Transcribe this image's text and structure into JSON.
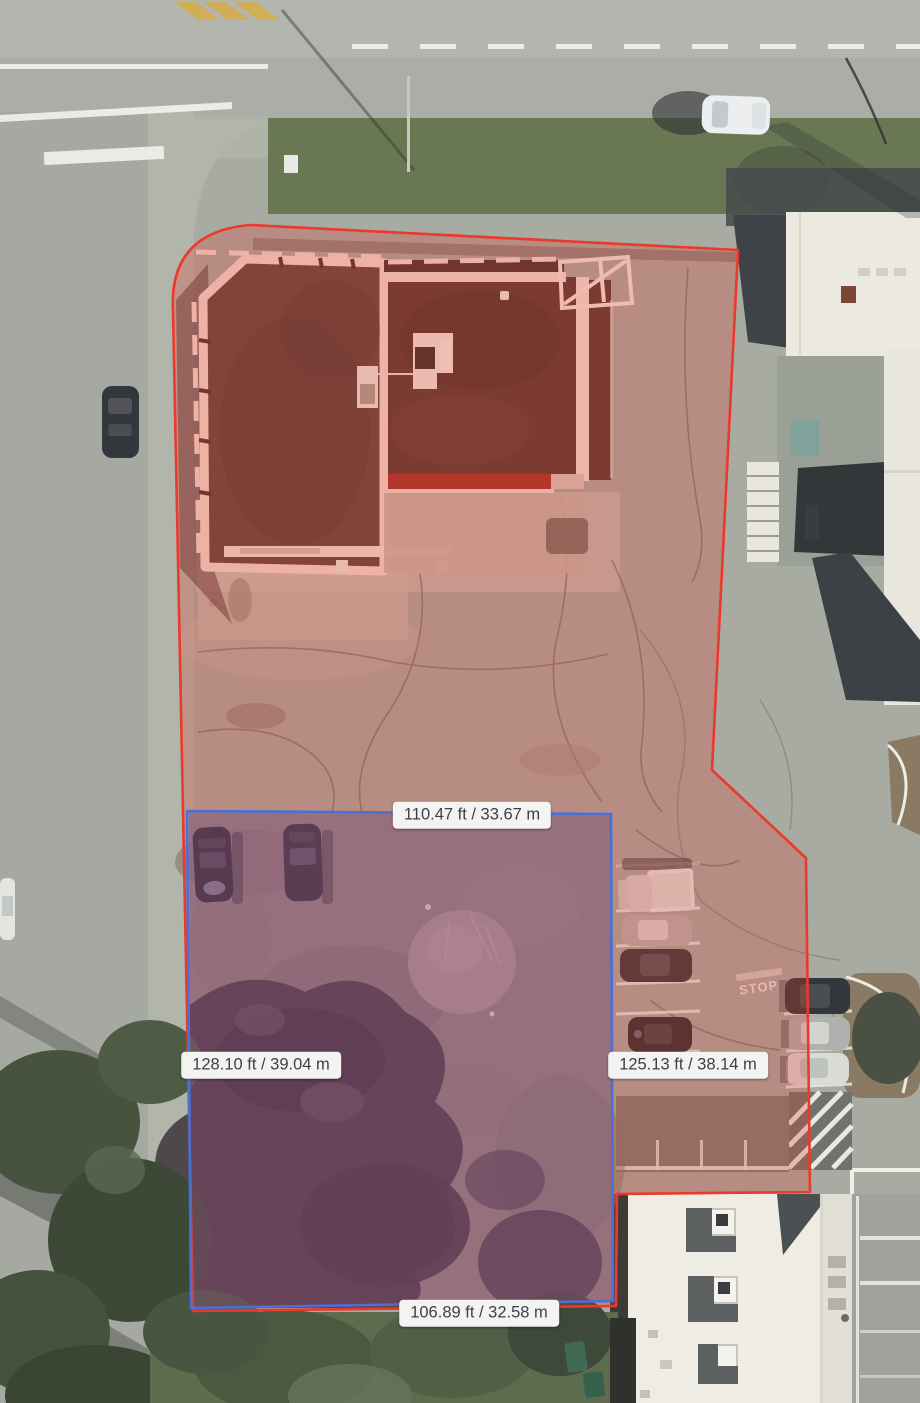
{
  "tool": {
    "name": "aerial-area-measurement",
    "view": "satellite"
  },
  "overlays": {
    "parcel_boundary": {
      "outline_color": "#ea392d",
      "fill_color": "#e03c2d",
      "fill_opacity": 0.27
    },
    "measured_area": {
      "outline_color": "#4a70d6",
      "fill_color": "#4a66d8",
      "fill_opacity": 0.2
    },
    "label_background": "#f3f3f1",
    "label_text_color": "#3b404b"
  },
  "measurements": {
    "top": {
      "label": "110.47 ft / 33.67 m",
      "feet": 110.47,
      "meters": 33.67,
      "side": "top"
    },
    "left": {
      "label": "128.10 ft / 39.04 m",
      "feet": 128.1,
      "meters": 39.04,
      "side": "left"
    },
    "right": {
      "label": "125.13 ft / 38.14 m",
      "feet": 125.13,
      "meters": 38.14,
      "side": "right"
    },
    "bottom": {
      "label": "106.89 ft / 32.58 m",
      "feet": 106.89,
      "meters": 32.58,
      "side": "bottom"
    }
  },
  "ground_markings": {
    "stop": "STOP"
  }
}
